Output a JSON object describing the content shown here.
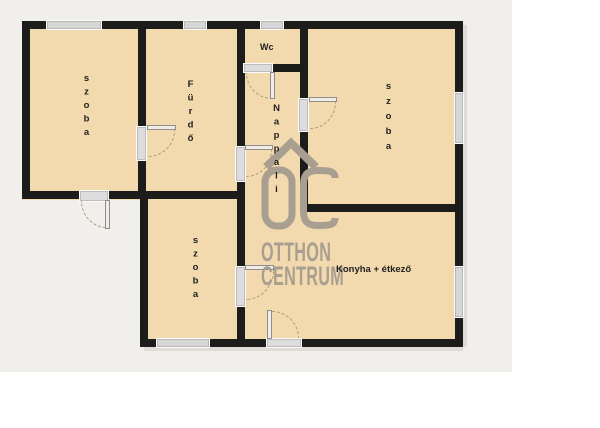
{
  "rooms": [
    {
      "id": "szoba-top-left",
      "label": "szoba"
    },
    {
      "id": "furdo",
      "label": "Fürdő"
    },
    {
      "id": "wc",
      "label": "Wc"
    },
    {
      "id": "nappali",
      "label": "Nappali"
    },
    {
      "id": "szoba-top-right",
      "label": "szoba"
    },
    {
      "id": "szoba-bottom",
      "label": "szoba"
    },
    {
      "id": "konyha-etkezo",
      "label": "Konyha + étkező"
    }
  ],
  "watermark": {
    "monogram": "OC",
    "brand_line1": "OTTHON",
    "brand_line2": "CENTRUM"
  },
  "colors": {
    "floor": "#f2d9ae",
    "wall": "#1c1c1a",
    "window": "#d6d6d6",
    "door_arc": "#ad9c7e",
    "watermark": "#a89f91",
    "backdrop": "#f0efeb"
  }
}
